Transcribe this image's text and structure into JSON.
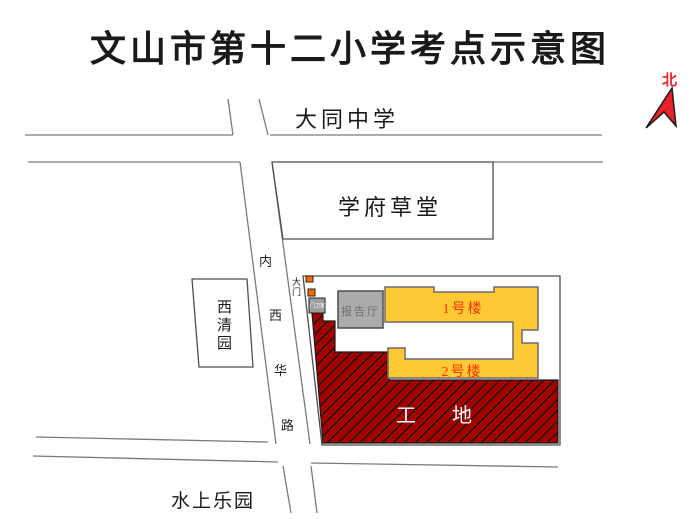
{
  "title": "文山市第十二小学考点示意图",
  "compass": {
    "label": "北"
  },
  "places": {
    "datong_school": "大同中学",
    "xuefu_caotang": "学府草堂",
    "xiqing_garden": "西清园",
    "water_park": "水上乐园"
  },
  "road": {
    "name": "内西华路",
    "chars": [
      "内",
      "西",
      "华",
      "路"
    ]
  },
  "school": {
    "gate": "大门",
    "guard_room": "门卫室",
    "lecture_hall": "报告厅",
    "building_1": "1号楼",
    "building_2": "2号楼",
    "construction_site": "工地"
  },
  "colors": {
    "building_fill": "#FFC933",
    "building_label": "#FF3300",
    "construction_fill": "#A40000",
    "construction_label": "#FFFFFF",
    "lecture_hall_fill": "#ABABAB",
    "guard_room_fill": "#9E9E9E",
    "gate_marker": "#FF6A00",
    "compass_red": "#E8212B",
    "road_line": "#7A7A7A"
  }
}
